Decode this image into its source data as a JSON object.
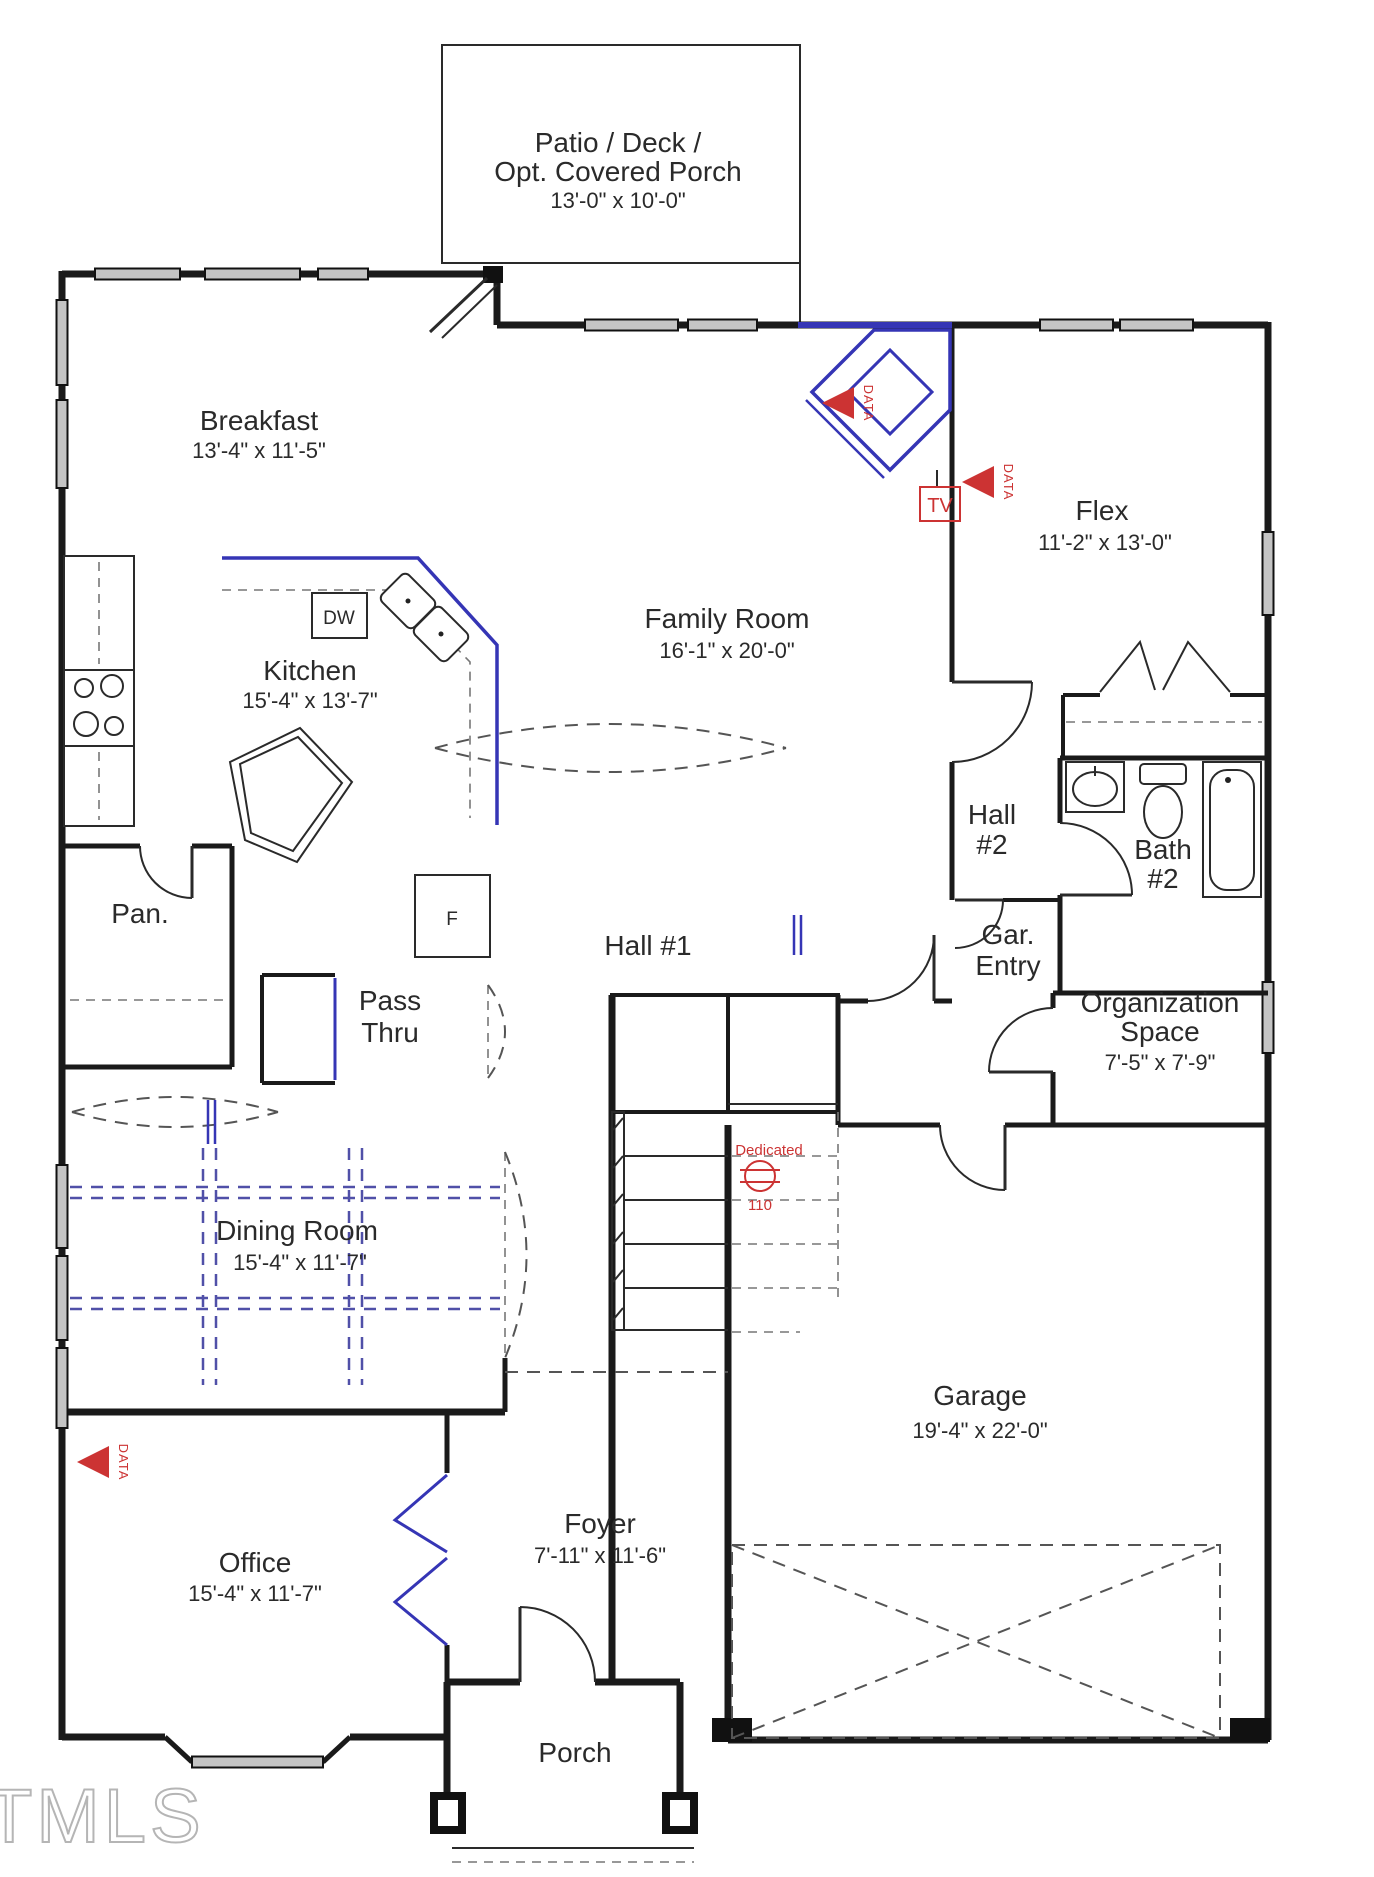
{
  "title": "First floor plan",
  "watermark": "TMLS",
  "colors": {
    "wall": "#1a1a1a",
    "accent_blue": "#3535b5",
    "annotation_red": "#cc3333",
    "window_fill": "#c4c4c4",
    "watermark_gray": "#b5b5b5"
  },
  "rooms": {
    "patio": {
      "name1": "Patio / Deck /",
      "name2": "Opt. Covered Porch",
      "dims": "13'-0\" x 10'-0\""
    },
    "breakfast": {
      "name": "Breakfast",
      "dims": "13'-4\" x 11'-5\""
    },
    "kitchen": {
      "name": "Kitchen",
      "dims": "15'-4\" x 13'-7\""
    },
    "family_room": {
      "name": "Family Room",
      "dims": "16'-1\" x 20'-0\""
    },
    "flex": {
      "name": "Flex",
      "dims": "11'-2\" x 13'-0\""
    },
    "hall_1": {
      "name": "Hall #1"
    },
    "hall_2": {
      "name1": "Hall",
      "name2": "#2"
    },
    "bath_2": {
      "name1": "Bath",
      "name2": "#2"
    },
    "gar_entry": {
      "name1": "Gar.",
      "name2": "Entry"
    },
    "organization": {
      "name1": "Organization",
      "name2": "Space",
      "dims": "7'-5\" x 7'-9\""
    },
    "pantry": {
      "name": "Pan."
    },
    "pass_thru": {
      "name1": "Pass",
      "name2": "Thru"
    },
    "dining_room": {
      "name": "Dining Room",
      "dims": "15'-4\" x 11'-7\""
    },
    "office": {
      "name": "Office",
      "dims": "15'-4\" x 11'-7\""
    },
    "foyer": {
      "name": "Foyer",
      "dims": "7'-11\" x 11'-6\""
    },
    "porch": {
      "name": "Porch"
    },
    "garage": {
      "name": "Garage",
      "dims": "19'-4\" x 22'-0\""
    }
  },
  "appliances": {
    "dishwasher": "DW",
    "fridge": "F",
    "tv": "TV"
  },
  "annotations": {
    "data": "DATA",
    "dedicated": "Dedicated",
    "dedicated_circuit": "110"
  }
}
